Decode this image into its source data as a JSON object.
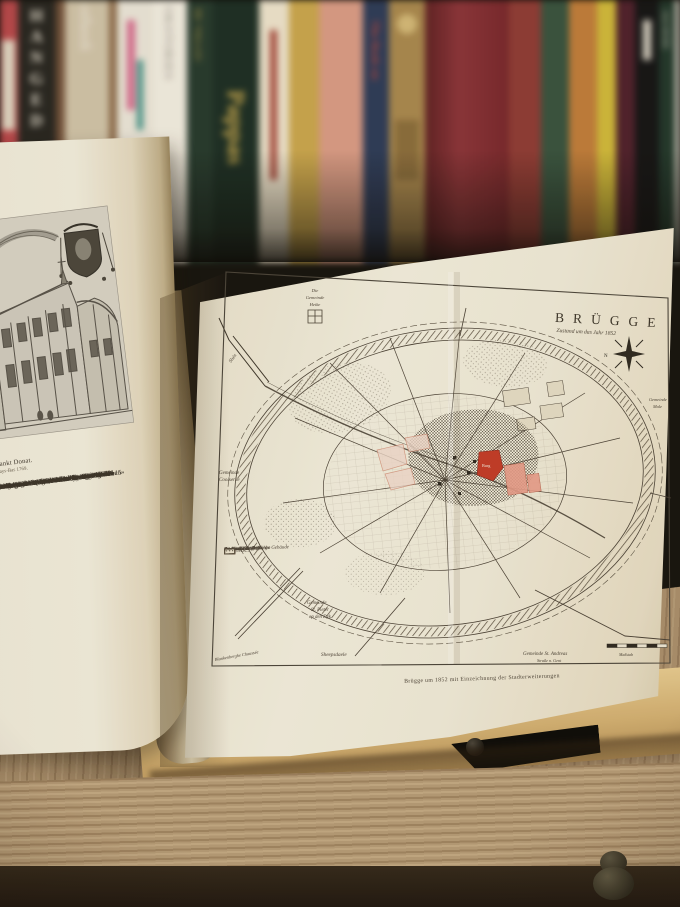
{
  "bookshelf": {
    "spine_labels": {
      "hanged": "HANGED HIST",
      "otheek": "otheek",
      "okstories": "OKSTORIES",
      "de_vallei": "DE VALLEI",
      "pappas": "Pappas",
      "the_book_on": "The Book on",
      "ale_boek": "ALE BOEK"
    }
  },
  "left_page": {
    "caption_title": "Sankt Donat.",
    "caption_sub": "Pays-Bas 1769.",
    "lines": [
      "e an die noch durchschimmernden Straßen",
      "lleicht mehr Recht, an eine merowingische",
      "e wichtigste Querstraße ist die Wollestraße",
      "Wagen Platz fand.  In der folgenden Quer-",
      "ute an, das verrät noch der heutige Name",
      "nichts aus.",
      "",
      "Hallen wird seit frühester Zeit das Haus C 15",
      "selberg und Geigereid für ein sehr früh an-",
      "ber lag auf dem Gebiet der jetzigen Hallen.",
      "",
      "h im Jahre 1564 den Namen «de groote steen»",
      "",
      "rimms Deutsche Mythologie, Göttingen, S. 89",
      "Est genus mercenariorum, quorum officium",
      "n super alios mercenarios vulgo reputantur «Bi-",
      "er Göttin Nerthus, das in Flandern die mero-",
      "wärtigen, aber dem gemeinen Haufen verhaßte",
      "ihren Schultern zu ziehen und zu bewachen",
      "n von dieser Straße entfernt.",
      "erhebt, der wie alle Plätze selbstverständlich",
      "mal ausdrücklich bestätigt.  Gilliodts, Coutume",
      "n «Cobra», dem ältesten landesherrlichen Fund",
      "en Grafen bestätigten mußte."
    ]
  },
  "map_page": {
    "title": "BRÜGGE",
    "subtitle": "Zustand um das Jahr 1852",
    "compass_n": "N",
    "stamp_lines": [
      "Die",
      "Gemeinde",
      "Heike"
    ],
    "labels": {
      "sluis": "Sluis",
      "coolkerke1": "Gemeinde",
      "coolkerke2": "Coolkerke",
      "st_pieter1": "Gemeinde",
      "st_pieter2": "St. Pieter",
      "st_pieter3": "op den Dyk",
      "sheepsdaele": "Sheepsdaele",
      "blankenberghe": "Blankenberghe Chaussée",
      "st_andreas": "Gemeinde St. Andreas",
      "strasse_gent": "Straße n. Gent",
      "male1": "Gemeinde",
      "male2": "Male",
      "burg": "Burg",
      "scale": "Maßstab"
    },
    "legend": {
      "title": "Legende:",
      "items": [
        {
          "label": "Bezirk der Oudenburg"
        },
        {
          "label": "der Burg"
        },
        {
          "label": "der Stadt von 1127"
        },
        {
          "label": "„  „  mit 1297"
        },
        {
          "label": "des St. Gilliesdorfs"
        },
        {
          "label": "Kirchen und öffentliche Gebäude"
        },
        {
          "label": "Fluß und Kanal"
        },
        {
          "label": "unbebaute Grünflächen"
        }
      ]
    },
    "caption": "Brügge um 1852 mit Einzeichnung der Stadterweiterungen"
  },
  "colors": {
    "paper": "#ece5d3",
    "map_ink": "#42392e",
    "map_red": "#c23a28",
    "map_salmon": "#e89c8a",
    "wood_stand": "#d9b97c",
    "wood_front": "#b59a76"
  }
}
